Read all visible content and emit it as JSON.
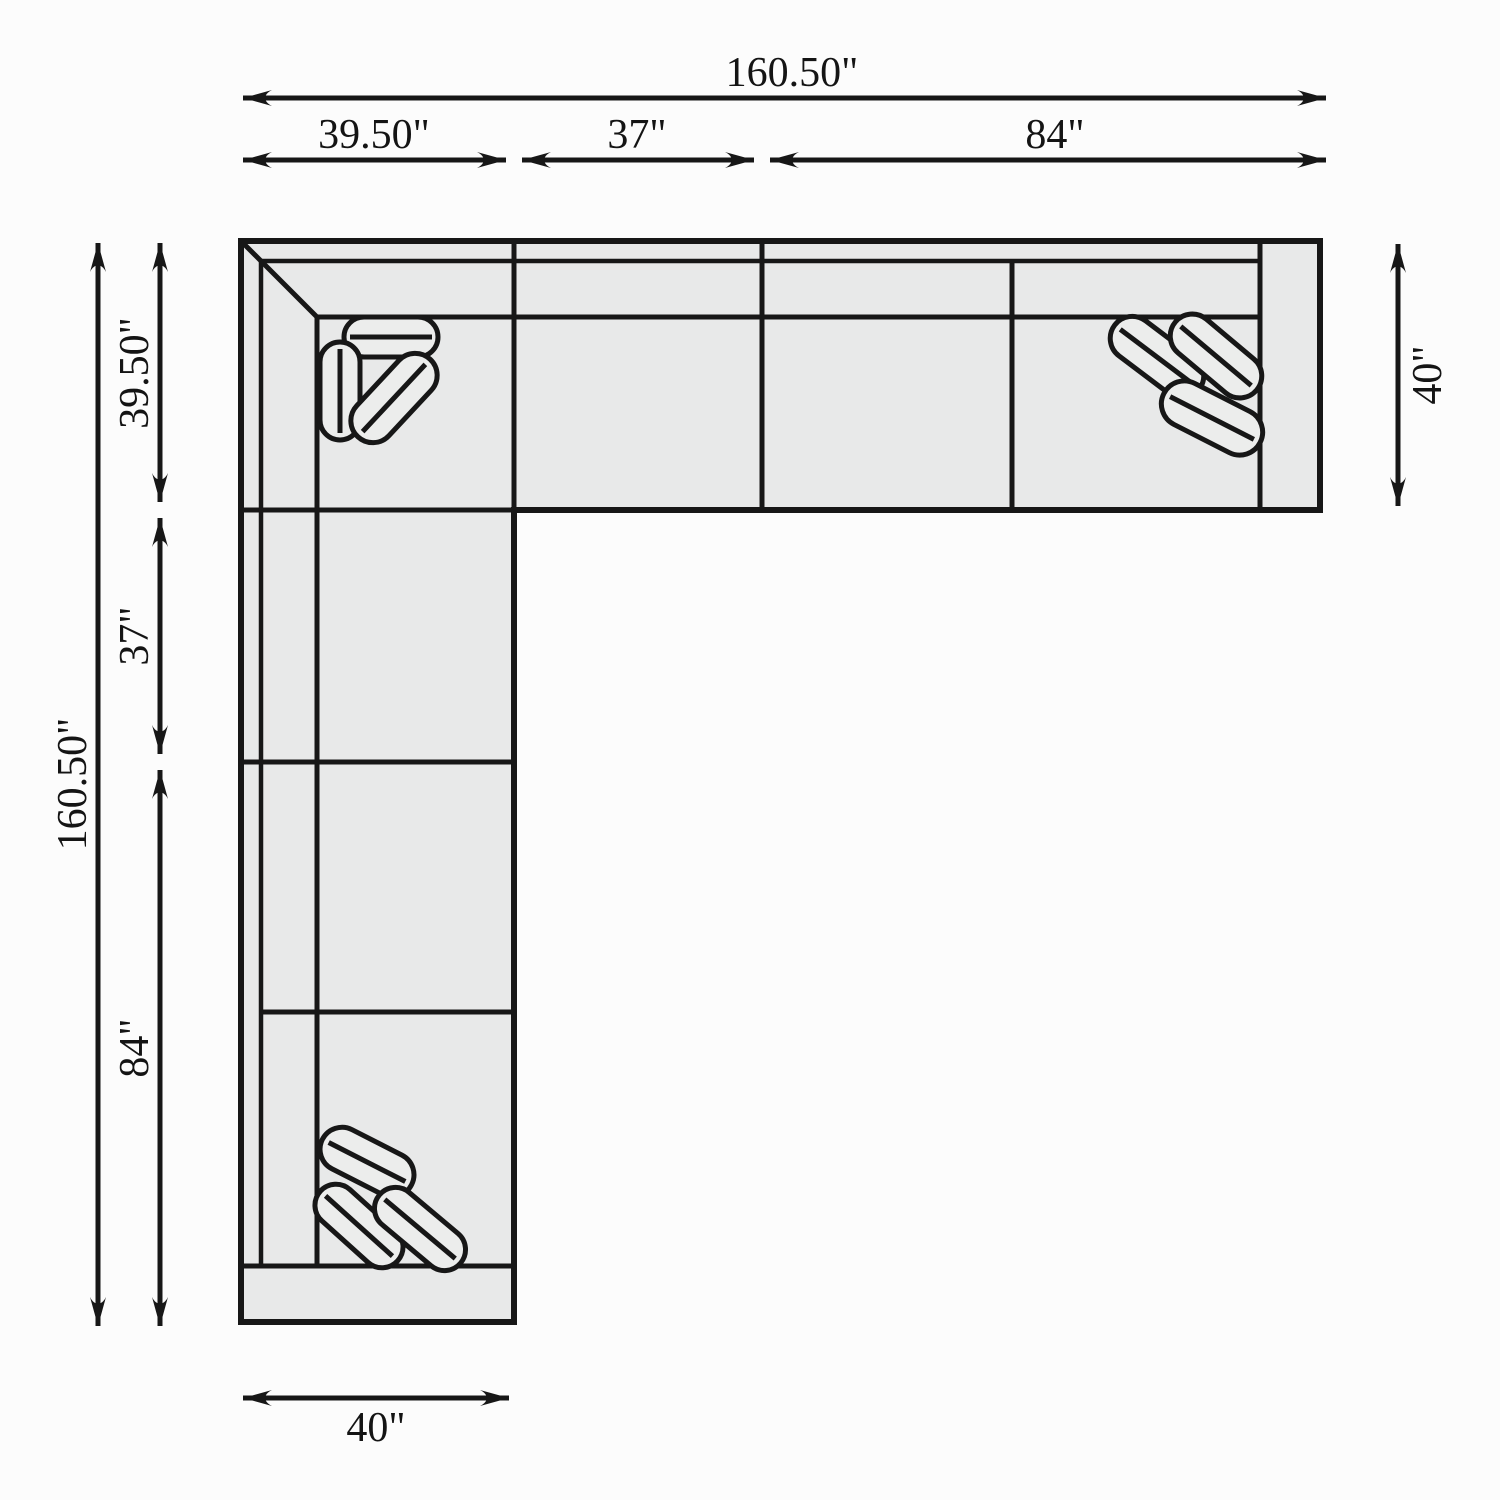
{
  "title": "Sectional sofa dimension diagram",
  "units": "inches",
  "labels": {
    "top_total": "160.50\"",
    "top_seg1": "39.50\"",
    "top_seg2": "37\"",
    "top_seg3": "84\"",
    "left_total": "160.50\"",
    "left_seg1": "39.50\"",
    "left_seg2": "37\"",
    "left_seg3": "84\"",
    "right_depth": "40\"",
    "bottom_width": "40\""
  },
  "dimensions": {
    "overall_width_in": 160.5,
    "overall_depth_in": 160.5,
    "top_segments_in": [
      39.5,
      37,
      84
    ],
    "left_segments_in": [
      39.5,
      37,
      84
    ],
    "right_depth_in": 40,
    "bottom_width_in": 40
  },
  "colors": {
    "background": "#fcfcfc",
    "sofa_fill": "#e8e9e9",
    "pillow_fill": "#ecedec",
    "line": "#171717"
  }
}
